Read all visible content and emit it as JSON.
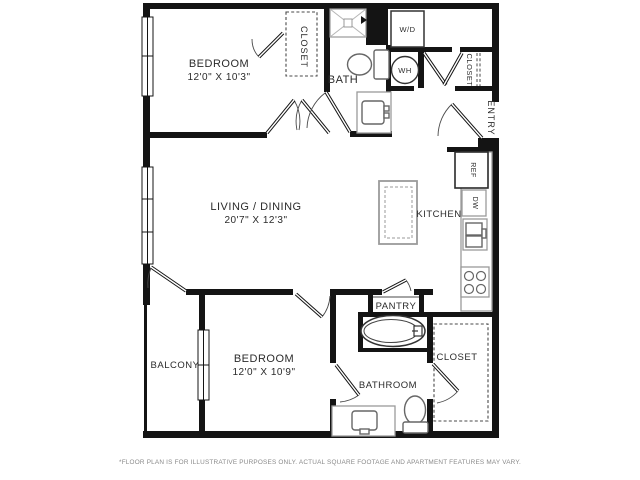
{
  "floor_plan": {
    "rooms": {
      "bedroom_top": {
        "name": "BEDROOM",
        "dims": "12'0\" X 10'3\""
      },
      "living_dining": {
        "name": "LIVING  / DINING",
        "dims": "20'7\" X 12'3\""
      },
      "bedroom_bottom": {
        "name": "BEDROOM",
        "dims": "12'0\" X 10'9\""
      },
      "bath": {
        "name": "BATH"
      },
      "bathroom": {
        "name": "BATHROOM"
      },
      "kitchen": {
        "name": "KITCHEN"
      },
      "balcony": {
        "name": "BALCONY"
      },
      "pantry": {
        "name": "PANTRY"
      },
      "entry": {
        "name": "ENTRY"
      },
      "closet_bedroom_top": {
        "name": "CLOSET"
      },
      "closet_entry": {
        "name": "CLOSET"
      },
      "closet_bathroom": {
        "name": "CLOSET"
      }
    },
    "appliances": {
      "washer_dryer": "W/D",
      "water_heater": "WH",
      "refrigerator": "REF",
      "dishwasher": "DW"
    },
    "footnote": "*FLOOR PLAN IS FOR ILLUSTRATIVE PURPOSES ONLY. ACTUAL SQUARE FOOTAGE AND APARTMENT FEATURES MAY VARY.",
    "colors": {
      "wall": "#141414",
      "fixture_outline": "#666666",
      "counter_outline": "#9a9a9a",
      "text": "#2b2b2b",
      "footnote_text": "#8a8a8a"
    }
  }
}
